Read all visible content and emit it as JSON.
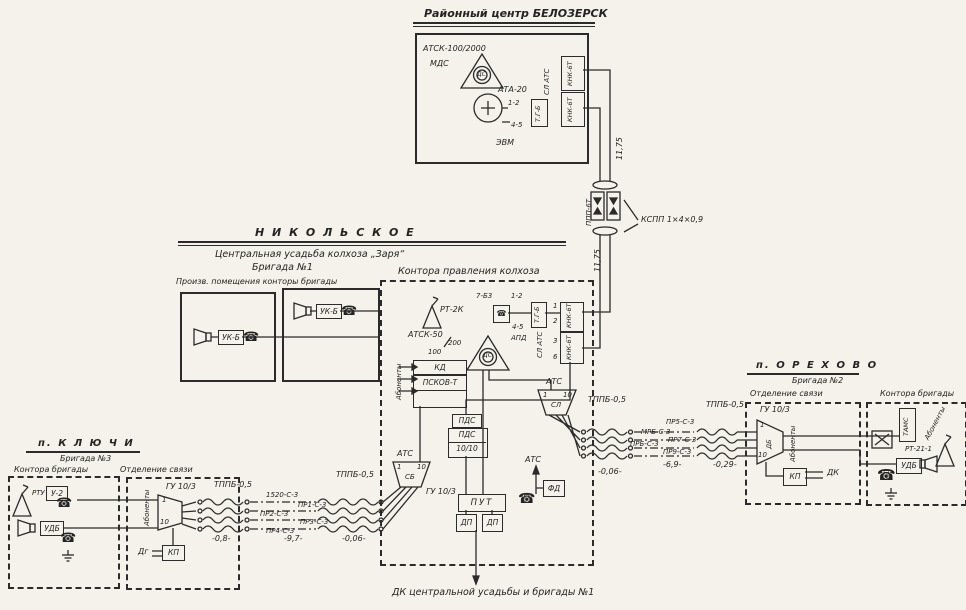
{
  "palette": {
    "paper": "#f4f2ea",
    "ink": "#2b2b2b"
  },
  "belozersk": {
    "title": "Районный центр БЕЛОЗЕРСК",
    "atsk": "АТСК-100/2000",
    "mds": "МДС",
    "rs": "ДС",
    "ata": "АТА-20",
    "pair12": "1-2",
    "pair45": "4-5",
    "evm": "ЭВМ",
    "tgb": "Т.Г-Б",
    "sl_ats": "СЛ АТС",
    "knk_top": "КНК-6Т",
    "knk_bot": "КНК-6Т"
  },
  "trunk": {
    "len_top": "11,75",
    "len_bot": "11,75",
    "nup": "ППП-6Т",
    "cable": "КСПП 1×4×0,9"
  },
  "nikolskoye": {
    "header": "Н И К О Л Ь С К О Е",
    "line1": "Центральная   усадьба   колхоза   „Заря“",
    "line2": "Бригада  №1",
    "prod_caption": "Произв. помещения конторы бригады",
    "uk_left": "УК-Б",
    "uk_right": "УК-Б"
  },
  "office": {
    "caption": "Контора правления колхоза",
    "rt2k": "РТ-2К",
    "rs": "ДС",
    "atsk": "АТСК-50",
    "atsk_cap": "200",
    "n100": "100",
    "kd": "КД",
    "pskov": "ПСКОВ-Т",
    "abonenty": "Абоненты",
    "t7b3": "7-Б3",
    "pair12": "1-2",
    "pair45": "4-5",
    "apd": "АПД",
    "tgb": "Т.Г-Б",
    "sl_ats": "СЛ АТС",
    "knk_top": "КНК-6Т",
    "knk_bot": "КНК-6Т",
    "ticks": [
      "1",
      "2",
      "3",
      "6"
    ],
    "pds1": "ПДС",
    "pds2": "ПДС",
    "pds3": "10/10",
    "ats_left": "АТС",
    "trap_left": {
      "t1": "1",
      "t2": "10",
      "label": "СБ"
    },
    "gu_left": "ГУ 10/3",
    "ats_right": "АТС",
    "trap_right": {
      "t1": "1",
      "t2": "10",
      "label": "СЛ"
    },
    "put": "ПУТ",
    "dp1": "ДП",
    "dp2": "ДП",
    "ats_mid": "АТС",
    "fd": "ФД"
  },
  "lines_right": {
    "cable_a": "ТППБ-0,5",
    "cable_b": "ТППБ-0,5",
    "w1": "ПР5-С-3",
    "w2": "МРБ-С-3",
    "w3": "ПРБ-С-3",
    "w4": "ПР7-С-3",
    "w5": "ПР9-С-3",
    "d1": "-0,06-",
    "d2": "-6,9-",
    "d3": "-0,29-"
  },
  "lines_left": {
    "cable_a": "ТППБ-0,5",
    "cable_b": "ТППБ-0,5",
    "w1": "1520-С-3",
    "w2": "ПР1-С-3",
    "w3": "ПР2-С-3",
    "w4": "ПР3-С-3",
    "w5": "ПР4-С-3",
    "d1": "-0,8-",
    "d2": "-9,7-",
    "d3": "-0,06-"
  },
  "orekhovo": {
    "header": "п.  О Р Е Х О В О",
    "sub": "Бригада  №2",
    "post_caption": "Отделение связи",
    "gu": "ГУ 10/3",
    "trap": {
      "t1": "1",
      "t2": "10",
      "label": "ДБ"
    },
    "abonenty": "Абоненты",
    "kp": "КП",
    "dk": "ДК",
    "office_caption": "Контора бригады",
    "tams": "ТАМС",
    "abonenty2": "Абоненты",
    "rt": "РТ-21-1",
    "udb": "УДБ"
  },
  "klyuchi": {
    "header": "п.  К Л Ю Ч И",
    "sub": "Бригада  №3",
    "office_caption": "Контора бригады",
    "rtu": "РТУ",
    "u2": "У-2",
    "udb": "УДБ",
    "post_caption": "Отделение связи",
    "gu": "ГУ 10/3",
    "abonenty": "Абоненты",
    "trap": {
      "t1": "1",
      "t2": "10"
    },
    "dg": "Дг",
    "kp": "КП"
  },
  "footer": {
    "caption": "ДК центральной усадьбы и бригады №1"
  }
}
